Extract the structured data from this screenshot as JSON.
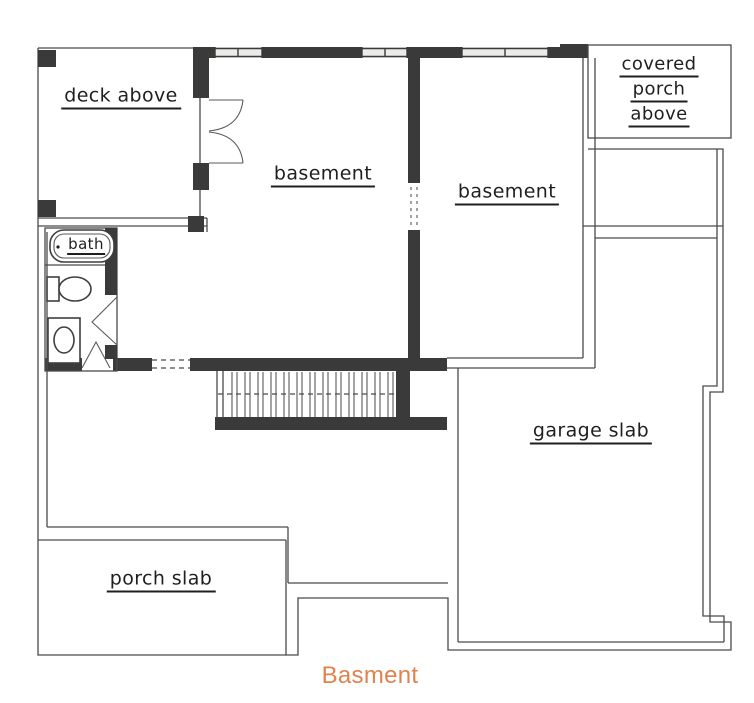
{
  "plan": {
    "labels": {
      "deck": "deck above",
      "basement_left": "basement",
      "basement_right": "basement",
      "covered_porch": [
        "covered",
        "porch",
        "above"
      ],
      "bath": "bath",
      "garage": "garage slab",
      "porch_slab": "porch slab"
    },
    "symbols": {
      "bathtub": "bathtub-symbol",
      "toilet": "toilet-symbol",
      "sink": "sink-symbol",
      "stairs": "stairs-symbol",
      "french_door": "double-door-swing",
      "windows": "window-symbols"
    },
    "colors": {
      "line": "#4a4a4a",
      "wall": "#3a3a3a",
      "text": "#1f1f1f",
      "window_fill": "#ebebe8",
      "background": "#ffffff",
      "caption": "#e0824e"
    }
  },
  "caption": {
    "text": "Basment"
  }
}
